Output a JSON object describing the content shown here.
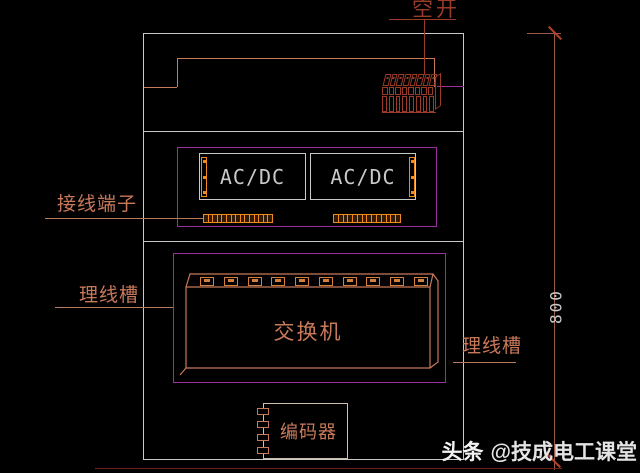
{
  "colors": {
    "background": "#000000",
    "outline": "#c9c9c9",
    "magenta": "#9b2f9b",
    "salmon": "#c8795a",
    "leader": "#b57a5e",
    "orange": "#f08a1e",
    "brick": "#9a3a28",
    "port": "#d4803c",
    "dim_line": "#9a5a48",
    "tick": "#b04228",
    "dim_red": "#6f2317",
    "light_tan": "#cfc0aa",
    "text_gray": "#c9c9c9"
  },
  "top_section": {
    "breaker_label": "空开"
  },
  "power_section": {
    "unit1_label": "AC/DC",
    "unit2_label": "AC/DC",
    "terminal_label": "接线端子"
  },
  "switch_section": {
    "switch_label": "交换机",
    "duct_left_label": "理线槽",
    "duct_right_label": "理线槽"
  },
  "encoder_section": {
    "encoder_label": "编码器"
  },
  "dimension": {
    "height_value": "800"
  },
  "watermark": {
    "brand": "头条",
    "account": "@技成电工课堂"
  },
  "counts": {
    "breaker_top_cells": 8,
    "breaker_mid_cells": 8,
    "breaker_fins": 8,
    "acdc_strip_dots": 3,
    "terminal1_blocks": 15,
    "terminal2_blocks": 14,
    "switch_ports": 10,
    "encoder_connectors": 4
  }
}
